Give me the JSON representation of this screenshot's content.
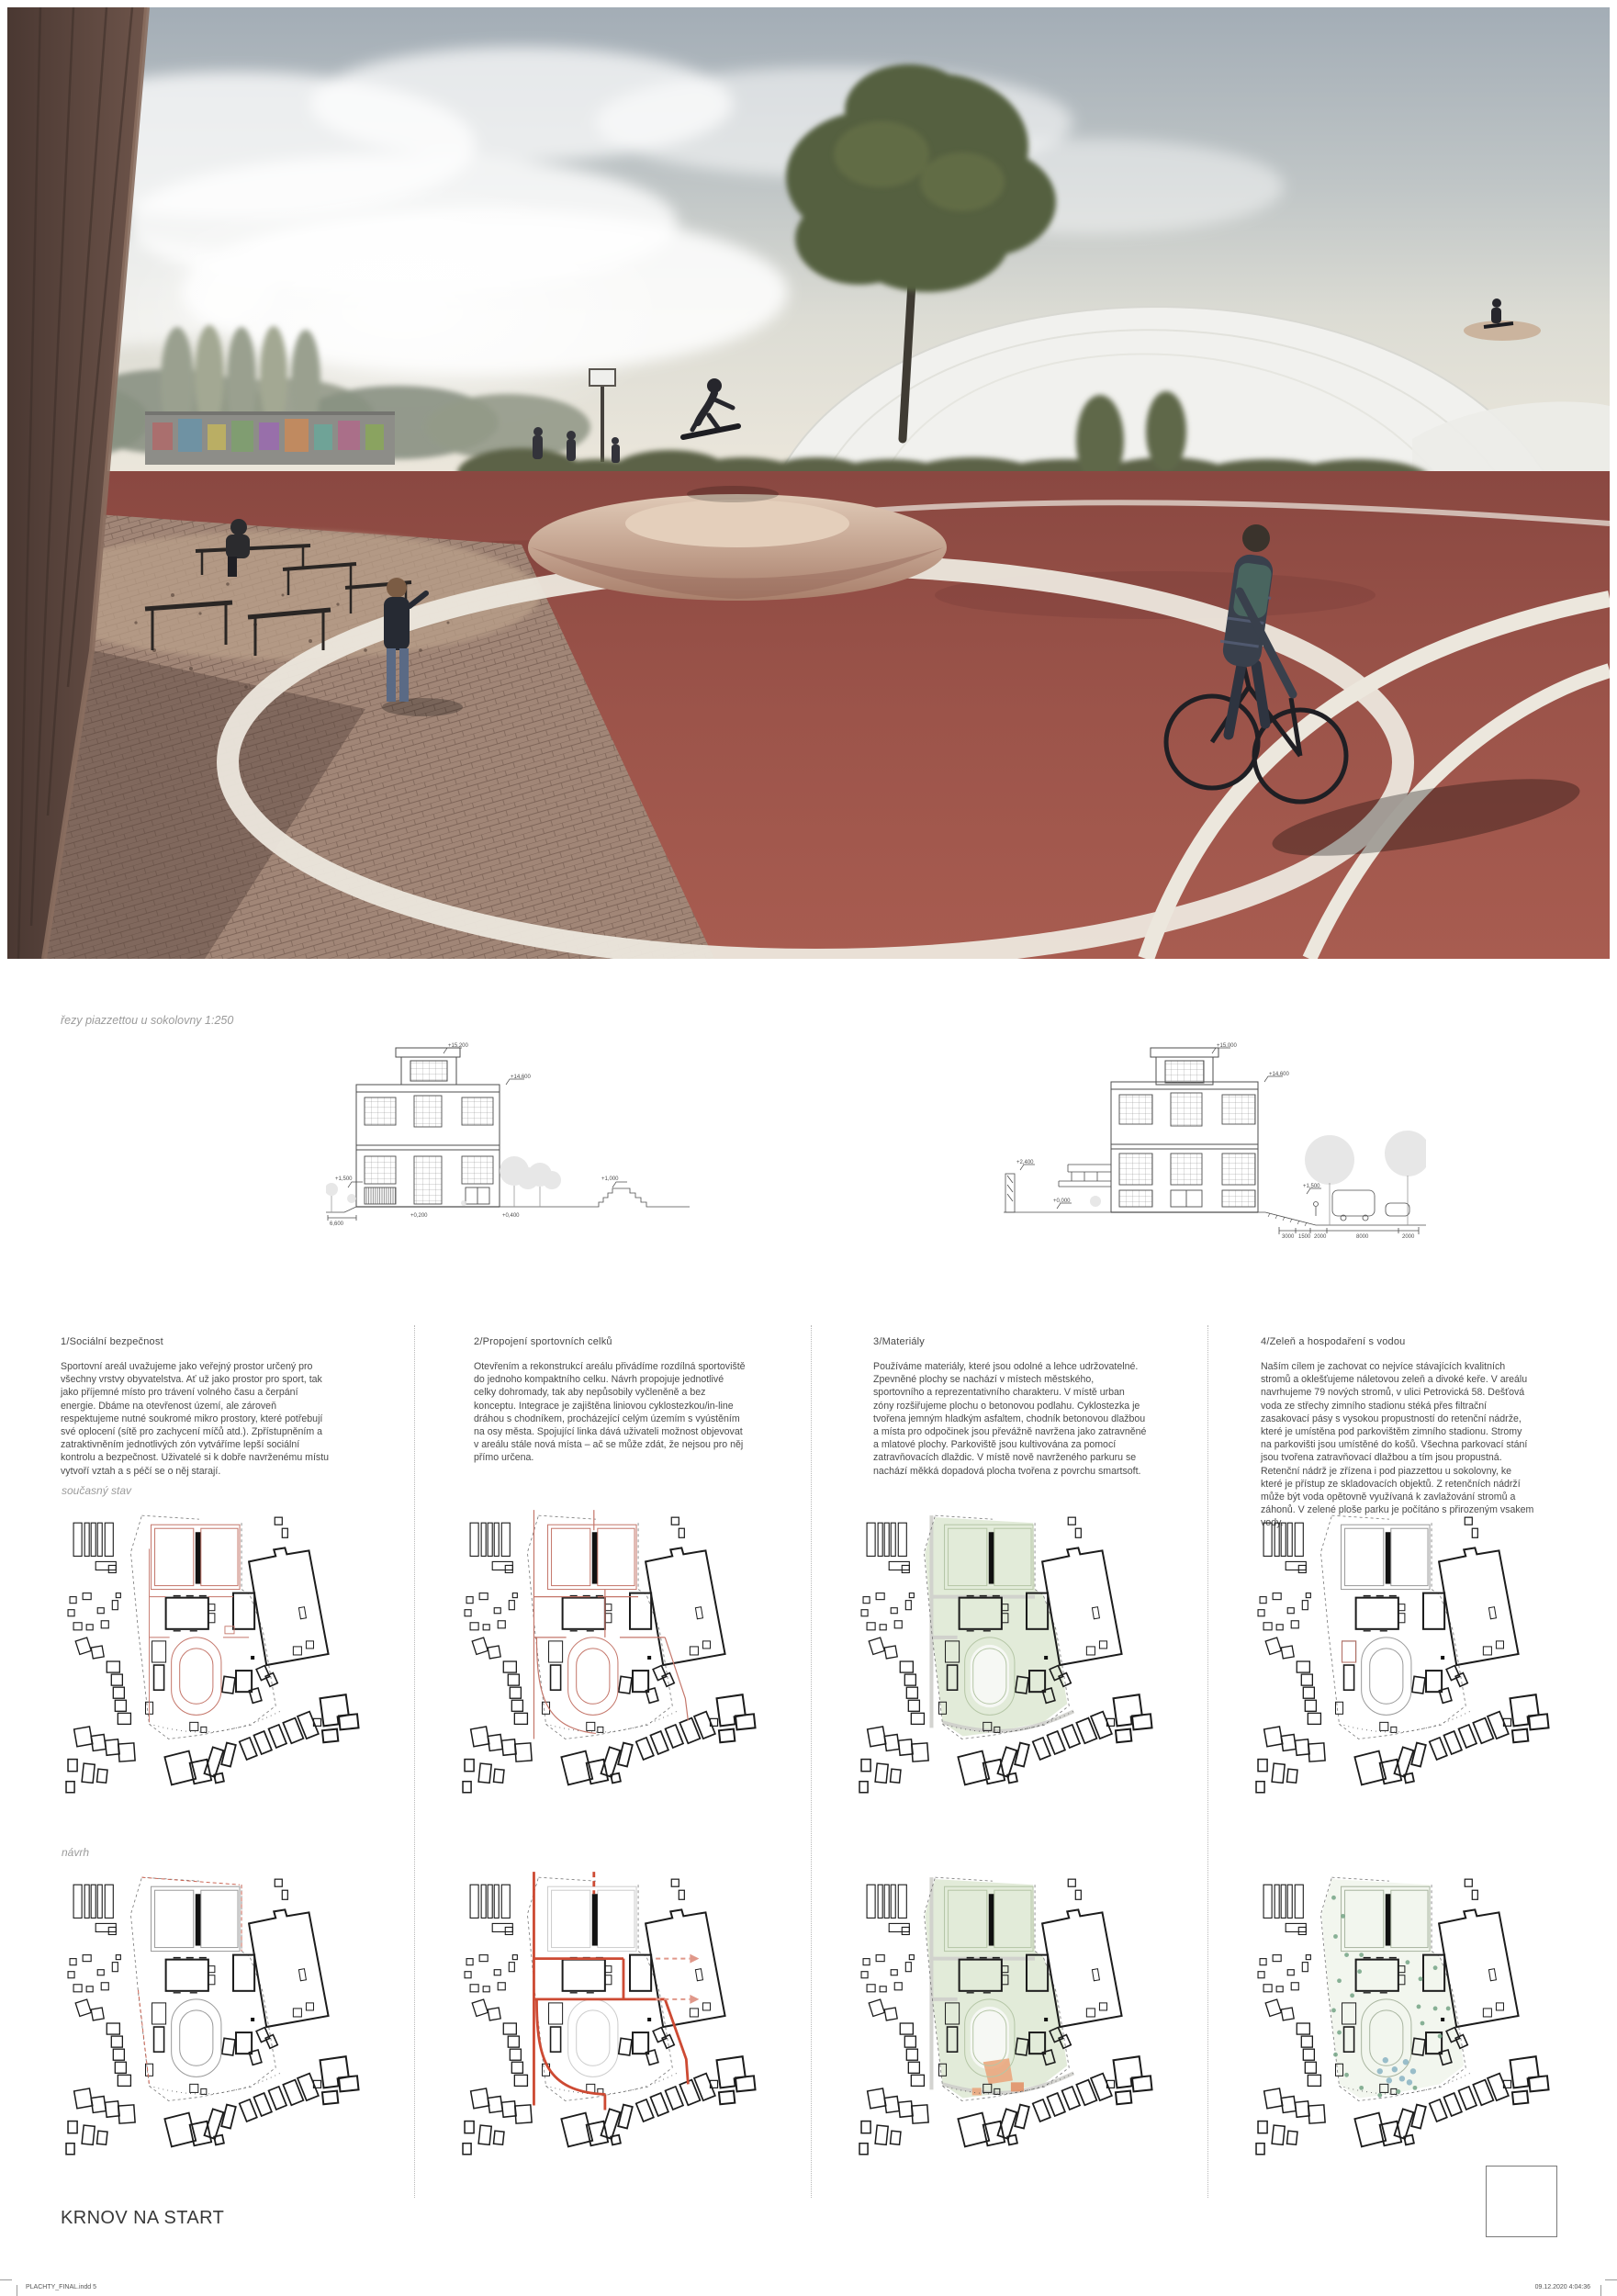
{
  "poster": {
    "title": "KRNOV NA START",
    "section_label": "řezy piazzettou u sokolovny 1:250",
    "row_labels": {
      "current": "současný stav",
      "proposal": "návrh"
    },
    "footer": {
      "left": "PLACHTY_FINAL.indd  5",
      "right": "09.12.2020  4:04:36"
    },
    "columns": [
      {
        "heading": "1/Sociální bezpečnost",
        "body": "Sportovní areál uvažujeme jako veřejný prostor určený pro všechny vrstvy obyvatelstva. Ať už jako prostor pro sport, tak jako příjemné místo pro trávení volného času a čerpání energie. Dbáme na otevřenost území, ale zároveň respektujeme nutné soukromé mikro prostory, které potřebují své oplocení (sítě pro zachycení míčů atd.). Zpřístupněním a zatraktivněním jednotlivých zón vytváříme lepší sociální kontrolu a bezpečnost. Uživatelé si k dobře navrženému místu vytvoří vztah a s péčí se o něj starají."
      },
      {
        "heading": "2/Propojení sportovních celků",
        "body": "Otevřením a rekonstrukcí areálu přivádíme rozdílná sportoviště do jednoho kompaktního celku. Návrh propojuje jednotlivé celky dohromady, tak aby nepůsobily vyčleněně a bez konceptu. Integrace je zajištěna liniovou cyklostezkou/in-line dráhou s chodníkem, procházející celým územím s vyústěním na osy města. Spojující linka dává uživateli možnost objevovat v areálu stále nová místa – ač se může zdát, že nejsou pro něj přímo určena."
      },
      {
        "heading": "3/Materiály",
        "body": "Používáme materiály, které jsou odolné a lehce udržovatelné. Zpevněné plochy se nachází v místech městského, sportovního a reprezentativního charakteru. V místě urban zóny rozšiřujeme plochu o betonovou podlahu. Cyklostezka je tvořena jemným hladkým asfaltem, chodník betonovou dlažbou a místa pro odpočinek jsou převážně navržena jako zatravněné a mlatové plochy. Parkoviště jsou kultivována za pomocí zatravňovacích dlaždic. V místě nově navrženého parkuru se nachází měkká dopadová plocha tvořena z povrchu smartsoft."
      },
      {
        "heading": "4/Zeleň a hospodaření s vodou",
        "body": "Naším cílem je zachovat co nejvíce stávajících kvalitních stromů a oklešťujeme náletovou zeleň a divoké keře. V areálu navrhujeme 79 nových stromů, v ulici Petrovická 58. Dešťová voda ze střechy zimního stadionu stéká přes filtrační zasakovací pásy s vysokou propustností do retenční nádrže, které je umístěna pod parkovištěm zimního stadionu. Stromy na parkovišti jsou umístěné do košů. Všechna parkovací stání jsou tvořena zatravňovací dlažbou a tím jsou propustná. Retenční nádrž je zřízena i pod piazzettou u sokolovny, ke které je přístup ze skladovacích objektů. Z retenčních nádrží může být voda opětovně využívaná k zavlažování stromů a záhonů. V zelené ploše parku je počítáno s přirozeným vsakem vody."
      }
    ],
    "elevations": [
      {
        "marks": {
          "top": "+15,200",
          "cornice": "+14,600",
          "left": "+1,500",
          "hill": "+1,000",
          "base_center": "+0,200",
          "base_right": "+0,400",
          "dim_left": "6,600"
        }
      },
      {
        "marks": {
          "top": "+15,000",
          "cornice": "+14,600",
          "left": "+2,400",
          "ground": "+0,000",
          "slope": "+1,500"
        },
        "dims": [
          "3000",
          "1500",
          "2000",
          "8000",
          "2000"
        ]
      }
    ],
    "colors": {
      "accent_red": "#c4766a",
      "accent_red_strong": "#cd4a33",
      "accent_green": "#e2ebd9",
      "accent_blue": "#90b7c6",
      "track_red": "#9c544a",
      "ink": "#1c1c1c"
    }
  }
}
